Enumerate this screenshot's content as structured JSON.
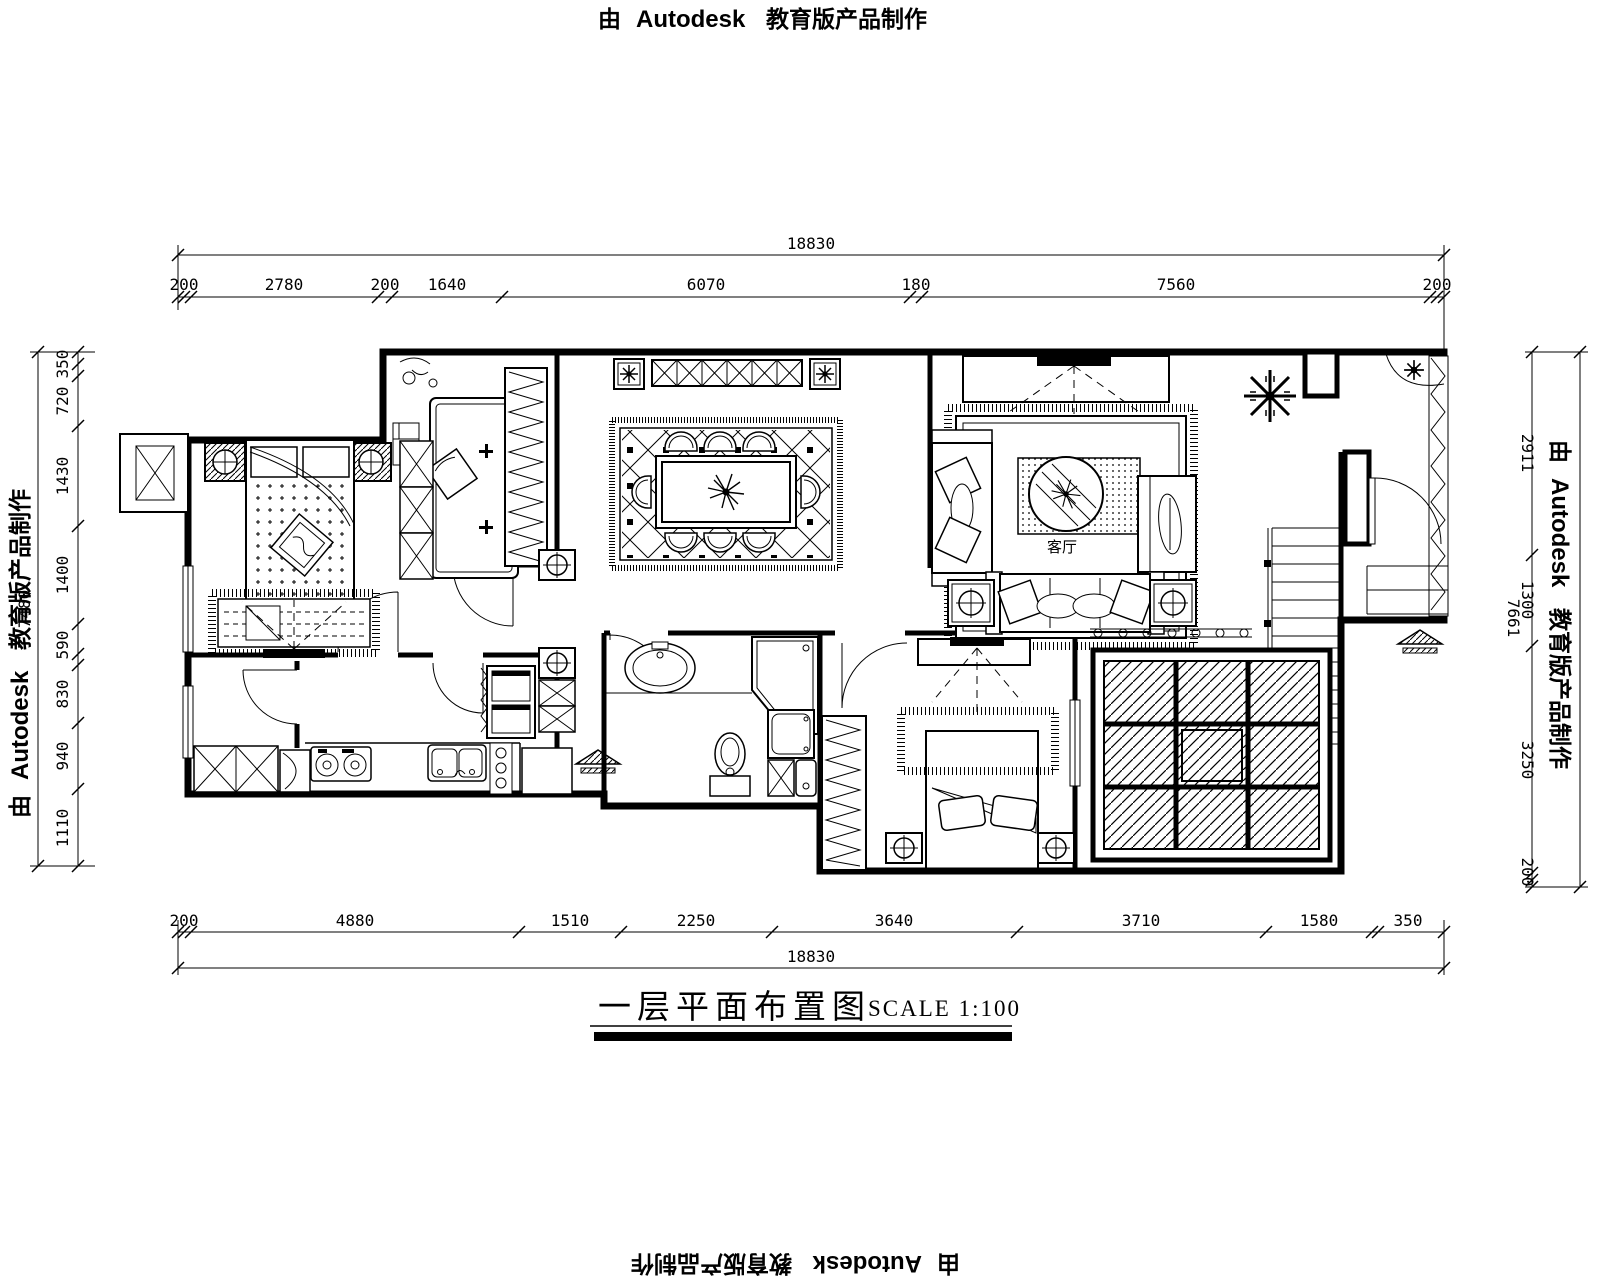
{
  "watermark": {
    "prefix": "由",
    "brand": "Autodesk",
    "suffix": "教育版产品制作"
  },
  "title": {
    "text": "一层平面布置图",
    "scale": "SCALE 1:100"
  },
  "rooms": {
    "living_room": "客厅"
  },
  "dims": {
    "top": {
      "total": "18830",
      "segments": [
        "200",
        "2780",
        "200",
        "1640",
        "6070",
        "180",
        "7560",
        "200"
      ]
    },
    "bottom": {
      "total": "18830",
      "segments": [
        "200",
        "4880",
        "1510",
        "2250",
        "3640",
        "3710",
        "1580",
        "350"
      ]
    },
    "left": {
      "total": "7480",
      "segments": [
        "350",
        "720",
        "1430",
        "1400",
        "590",
        "830",
        "940",
        "1110"
      ]
    },
    "right": {
      "total": "7661",
      "segments": [
        "2911",
        "1300",
        "3250",
        "200"
      ]
    }
  }
}
